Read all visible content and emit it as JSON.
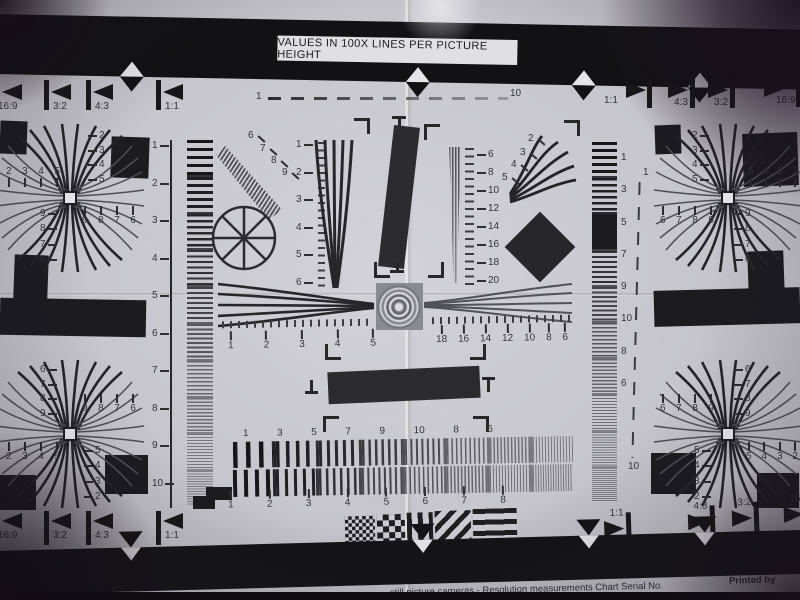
{
  "header": {
    "title": "VALUES IN 100X LINES PER PICTURE HEIGHT"
  },
  "aspect_markers": {
    "top_left": [
      "16:9",
      "3:2",
      "4:3",
      "1:1"
    ],
    "top_right": [
      "1:1",
      "4:3",
      "3:2",
      "16:9"
    ],
    "bottom_left": [
      "16:9",
      "3:2",
      "4:3",
      "1:1"
    ],
    "bottom_right": [
      "1:1",
      "4:3",
      "3:2",
      "16:9"
    ]
  },
  "frame_scale": {
    "top_left_label": "1",
    "top_right_label": "10"
  },
  "left_ruler": [
    "1",
    "2",
    "3",
    "4",
    "5",
    "6",
    "7",
    "8",
    "9",
    "10"
  ],
  "right_ruler": [
    "1",
    "3",
    "5",
    "7",
    "9",
    "10",
    "8",
    "6"
  ],
  "right_dashed_scale": {
    "top": "1",
    "bottom": "10"
  },
  "center": {
    "diagonal_wedge_labels": [
      "6",
      "7",
      "8",
      "9"
    ],
    "vertical_wedge_ruler": [
      "1",
      "2",
      "3",
      "4",
      "5",
      "6"
    ],
    "fine_wedge_ruler": [
      "6",
      "8",
      "10",
      "12",
      "14",
      "16",
      "18",
      "20"
    ],
    "curved_fan_labels": [
      "2",
      "3",
      "4",
      "5"
    ],
    "horizontal_ruler_left": [
      "1",
      "2",
      "3",
      "4",
      "5"
    ],
    "horizontal_ruler_right": [
      "18",
      "16",
      "14",
      "12",
      "10",
      "8",
      "6"
    ]
  },
  "corner_crosses": {
    "top_left": {
      "vertical_top": [
        "2",
        "3",
        "4",
        "5"
      ],
      "horizontal_left": [
        "2",
        "3",
        "4",
        "5"
      ],
      "vertical_bottom": [
        "9",
        "8",
        "7",
        "6"
      ],
      "horizontal_right": [
        "9",
        "8",
        "7",
        "6"
      ]
    },
    "top_right": {
      "vertical_top": [
        "2",
        "3",
        "4",
        "5"
      ],
      "horizontal_right": [
        "5",
        "4",
        "3",
        "2"
      ],
      "vertical_bottom": [
        "9",
        "8",
        "7",
        "6"
      ],
      "horizontal_left": [
        "6",
        "7",
        "8",
        "9"
      ]
    },
    "bottom_left": {
      "vertical_top": [
        "6",
        "7",
        "8",
        "9"
      ],
      "horizontal_right": [
        "9",
        "8",
        "7",
        "6"
      ],
      "vertical_bottom": [
        "5",
        "4",
        "3",
        "2"
      ],
      "horizontal_left": [
        "2",
        "3",
        "4",
        "5"
      ]
    },
    "bottom_right": {
      "vertical_top": [
        "6",
        "7",
        "8",
        "9"
      ],
      "horizontal_left": [
        "6",
        "7",
        "8",
        "9"
      ],
      "vertical_bottom": [
        "5",
        "4",
        "3",
        "2"
      ],
      "horizontal_right": [
        "5",
        "4",
        "3",
        "2"
      ]
    }
  },
  "bottom_sweep": {
    "top_labels": [
      "1",
      "3",
      "5",
      "7",
      "9",
      "10",
      "8",
      "6"
    ],
    "bottom_labels": [
      "1",
      "2",
      "3",
      "4",
      "5",
      "6",
      "7",
      "8"
    ]
  },
  "footer": {
    "left_text": "still picture cameras - Resolution measurements Chart Serial No.",
    "right_text": "Printed by"
  },
  "colors": {
    "paper": "#c7c6ce",
    "ink": "#232328",
    "bar": "#141417",
    "vignette": "#1c1220"
  }
}
